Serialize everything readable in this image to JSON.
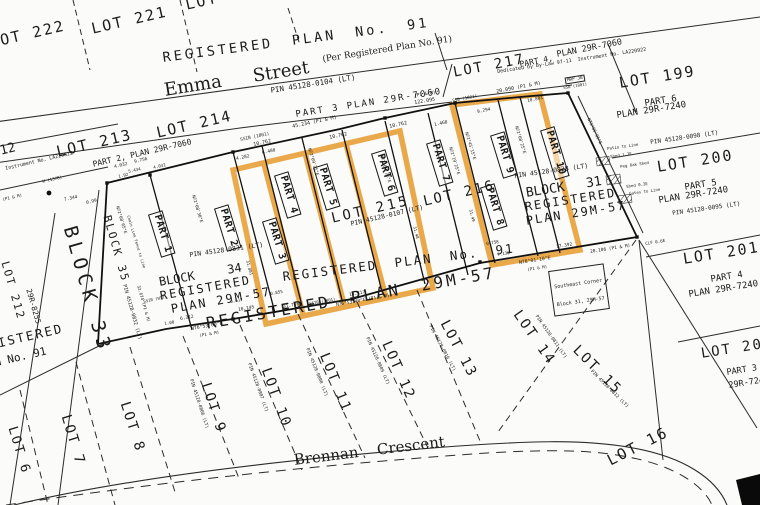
{
  "colors": {
    "highlight": "#E8A33C",
    "ink": "#1c1c1c",
    "paper": "#fbfbf9"
  },
  "labels": {
    "lot222": "LOT 222",
    "lot221": "LOT 221",
    "lot220": "LOT 220",
    "regplan91_top": "REGISTERED PLAN No. 91",
    "emma_street": "Emma Street",
    "emma_per": "(Per Registered Plan No. 91)",
    "pin_0104": "PIN 45128-0104 (LT)",
    "part3_7060": "PART 3 PLAN 29R-7060",
    "d_122095": "122.095",
    "p1m_a": "(P1 & M)",
    "ssib_1801_a": "SSIB (1801)",
    "d_45234": "45.234 (P1 & M)",
    "d_10762_a": "10.762",
    "d_10762_b": "10.762",
    "d_10762_c": "10.762",
    "d_4282": "4.282",
    "d_6480": "6.480",
    "d_4032": "4.032",
    "d_9756": "9.756",
    "d_192": "1.92",
    "d_1468": "1.468",
    "d_20090": "20.090 (P1 & M)",
    "d_10801": "10.801",
    "d_9294": "9.294",
    "ssb_1801_b": "SSB (1801)",
    "mrp_jb": "MRP JB",
    "ssb_1801_c": "SSB (1801)",
    "lot217": "LOT 217",
    "part4_7060a": "PART 4,",
    "plan_7060b": "PLAN 29R-7060",
    "dedicated": "Dedicated by By-Law 97-11  Instrument No. LA220922",
    "lot199": "LOT 199",
    "part6": "PART 6",
    "plan7240_a": "PLAN 29R-7240",
    "pin_0098": "PIN 45128-0098 (LT)",
    "note_patio": "Patio to Line",
    "note_shed17": "Shed 1.7E",
    "note_pegoak": "Peg Oak Shed",
    "note_shed03": "Shed 0.3E",
    "note_gates": "Gates to Line",
    "clf": "CLF 0.6E",
    "lot200": "LOT 200",
    "part5": "PART 5",
    "plan7240_b": "PLAN 29R-7240",
    "pin_0095": "PIN 45128-0095 (LT)",
    "lot201": "LOT 201",
    "part4b": "PART 4",
    "plan7240_c": "PLAN 29R-7240",
    "lot20x": "LOT 20",
    "part3b": "PART 3",
    "plan7240_d": "29R-7240",
    "lot213": "LOT 213",
    "lot214": "LOT 214",
    "part2_7060": "PART 2, PLAN 29R-7060",
    "lot212_frag": "212",
    "instr_822": "Instrument No. LA220822",
    "d_5434": "5.434",
    "d_4032b": "4.032",
    "w1378": "W (1378)",
    "d_7344": "7.344",
    "d_099": "0.99",
    "p1m_left": "(P1 & M)",
    "block35": "BLOCK 35",
    "pin_0832": "PIN 45128-0832 (LT)",
    "d_32674": "32.674 (P1 & M)",
    "block33": "BLOCK 33",
    "lot212_v": "LOT 212",
    "plan8255": "29R-8255",
    "reg_frag": "REGISTERED",
    "plan91_frag": "PLAN No. 91",
    "bear_a": "N72°08'05\"E",
    "bear_b": "N72°08'30\"E",
    "bear_c": "N72°09'25\"E",
    "bear_d": "N72°09'25\"E",
    "bear_e": "N72°19'25\"E",
    "bear_f": "N72°45'15\"E",
    "bear_g": "N72°08'25\"E",
    "bear_h": "N73°05'05\"E",
    "clfence": "Chain Link Fence to Line",
    "lot215": "LOT 215",
    "pin_0107": "PIN 45128-0107 (LT)",
    "lot216": "LOT 216",
    "regplan91_strip": "REGISTERED PLAN No. 91",
    "block34": "BLOCK 34",
    "reg34": "REGISTERED",
    "plan29m57_34": "PLAN 29M-57",
    "pin_0831": "PIN 45128-0831 (LT)",
    "block31": "BLOCK 31",
    "reg31": "REGISTERED",
    "plan29m57_31": "PLAN 29M-57",
    "pin_0828": "PIN 45128-0828 (LT)",
    "se1": "Southeast Corner",
    "se2": "Block 31, 29M-57",
    "d_100": "1.00",
    "d_6312": "6.312",
    "bear_7653": "N76°53'00\"E",
    "p1m_b": "(P1 & M)",
    "d_10145": "10.145",
    "d_0617": "0.617",
    "d_0855": "0.855",
    "d_31736": "31.736",
    "ssib_1801_d": "SSIB (1801)",
    "d_13217": "13.217",
    "bear_76534": "N76°53'40\"E (P1 & M)",
    "d_31801": "31.801",
    "d_3148": "31.48",
    "d_3149": "31.49",
    "ssib_wit": "SSIB (WIT)",
    "d_17392": "17.392",
    "bear_7801": "N78°01'10\"E",
    "p1m_c": "(P1 & M)",
    "d_20106": "20.106 (P1 & M)",
    "d_0758": "0.758",
    "d_7130": "7.130",
    "reg29m57_big": "REGISTERED PLAN 29M-57",
    "brennan": "Brennan Crescent"
  },
  "parts": [
    "PART 1",
    "PART 2",
    "PART 3",
    "PART 4",
    "PART 5",
    "PART 6",
    "PART 7",
    "PART 8",
    "PART 9",
    "PART 10"
  ],
  "bottom_lots": [
    {
      "label": "LOT 6"
    },
    {
      "label": "LOT 7"
    },
    {
      "label": "LOT 8"
    },
    {
      "label": "LOT 9",
      "pin": "PIN 45128-0806 (LT)"
    },
    {
      "label": "LOT 10",
      "pin": "PIN 45128-0807 (LT)"
    },
    {
      "label": "LOT 11",
      "pin": "PIN 45128-0808 (LT)"
    },
    {
      "label": "LOT 12",
      "pin": "PIN 45128-0809 (LT)"
    },
    {
      "label": "LOT 13",
      "pin": "PIN 45128-0810 (LT)"
    },
    {
      "label": "LOT 14",
      "pin": "PIN 45128-0811 (LT)"
    },
    {
      "label": "LOT 15",
      "pin": "PIN 45128-0812 (LT)"
    },
    {
      "label": "LOT 16"
    }
  ]
}
